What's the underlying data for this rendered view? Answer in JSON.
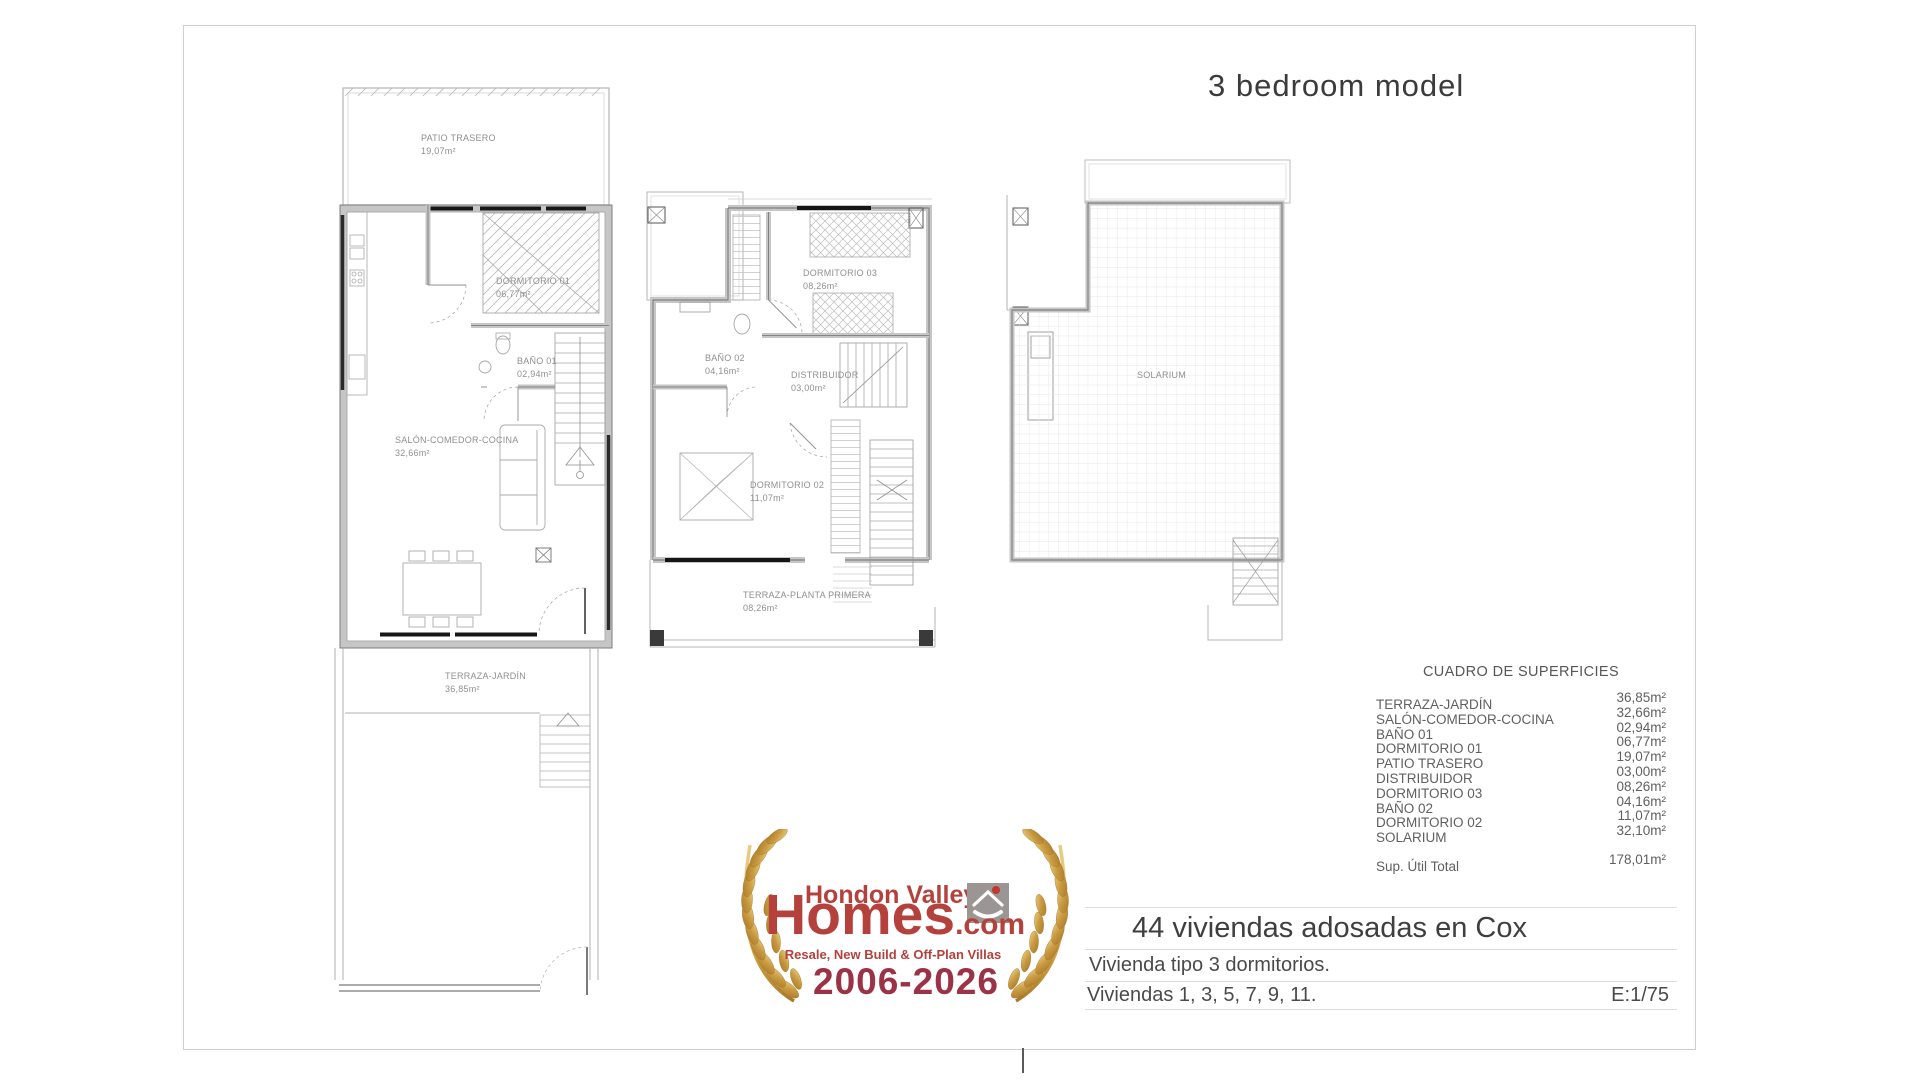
{
  "page": {
    "title": "3 bedroom model"
  },
  "plans": {
    "ground_floor": {
      "patio": {
        "name": "PATIO TRASERO",
        "area": "19,07m²"
      },
      "dorm01": {
        "name": "DORMITORIO 01",
        "area": "06,77m²"
      },
      "bano01": {
        "name": "BAÑO 01",
        "area": "02,94m²"
      },
      "salon": {
        "name": "SALÓN-COMEDOR-COCINA",
        "area": "32,66m²"
      },
      "terraza": {
        "name": "TERRAZA-JARDÍN",
        "area": "36,85m²"
      }
    },
    "first_floor": {
      "dorm03": {
        "name": "DORMITORIO 03",
        "area": "08,26m²"
      },
      "bano02": {
        "name": "BAÑO 02",
        "area": "04,16m²"
      },
      "distrib": {
        "name": "DISTRIBUIDOR",
        "area": "03,00m²"
      },
      "dorm02": {
        "name": "DORMITORIO 02",
        "area": "11,07m²"
      },
      "terraza": {
        "name": "TERRAZA-PLANTA PRIMERA",
        "area": "08,26m²"
      }
    },
    "roof": {
      "solarium": {
        "name": "SOLARIUM"
      }
    }
  },
  "surface_table": {
    "title": "CUADRO DE SUPERFICIES",
    "rows": [
      {
        "label": "TERRAZA-JARDÍN",
        "value": "36,85m²"
      },
      {
        "label": "SALÓN-COMEDOR-COCINA",
        "value": "32,66m²"
      },
      {
        "label": "BAÑO 01",
        "value": "02,94m²"
      },
      {
        "label": "DORMITORIO 01",
        "value": "06,77m²"
      },
      {
        "label": "PATIO TRASERO",
        "value": "19,07m²"
      },
      {
        "label": "DISTRIBUIDOR",
        "value": "03,00m²"
      },
      {
        "label": "DORMITORIO 03",
        "value": "08,26m²"
      },
      {
        "label": "BAÑO 02",
        "value": "04,16m²"
      },
      {
        "label": "DORMITORIO 02",
        "value": "11,07m²"
      },
      {
        "label": "SOLARIUM",
        "value": "32,10m²"
      }
    ],
    "total_label": "Sup. Útil Total",
    "total_value": "178,01m²"
  },
  "title_block": {
    "project": "44 viviendas adosadas en Cox",
    "line1": "Vivienda tipo 3 dormitorios.",
    "line2": "Viviendas 1, 3, 5, 7, 9, 11.",
    "scale": "E:1/75"
  },
  "logo": {
    "brand_top": "Hondon Valley",
    "brand_main": "Homes",
    "brand_suffix": ".com",
    "tagline": "Resale, New Build & Off-Plan Villas",
    "years": "2006-2026",
    "colors": {
      "red": "#b5413c",
      "maroon": "#9c3246",
      "gold": "#c89a3f",
      "icon_gray": "#9b9694"
    }
  }
}
